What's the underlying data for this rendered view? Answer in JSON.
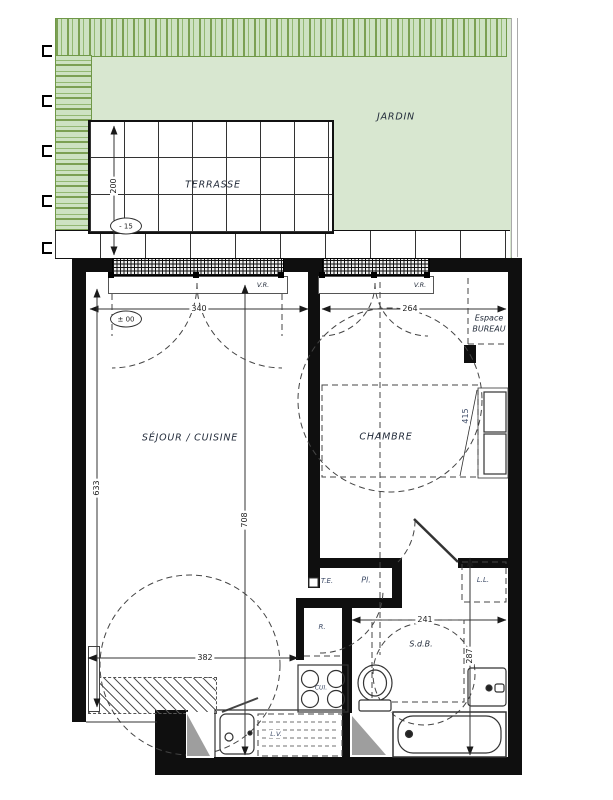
{
  "plan": {
    "rooms": {
      "jardin": "JARDIN",
      "terrasse": "TERRASSE",
      "sejour_cuisine": "SÉJOUR / CUISINE",
      "chambre": "CHAMBRE",
      "espace_bureau_line1": "Espace",
      "espace_bureau_line2": "BUREAU",
      "sdb": "S.d.B."
    },
    "equipment": {
      "vr": "V.R.",
      "te": "T.E.",
      "pl": "Pl.",
      "r": "R.",
      "cui": "CUI.",
      "lv": "L.V.",
      "ll": "L.L."
    },
    "levels": {
      "terrasse": "- 15",
      "interieur": "± 00"
    },
    "dimensions": {
      "terrasse_depth": "200",
      "sejour_window": "340",
      "chambre_window": "264",
      "sejour_depth": "633",
      "total_depth": "708",
      "sejour_width": "382",
      "sdb_width": "241",
      "sdb_depth": "287",
      "chambre_depth": "415"
    },
    "colors": {
      "garden_fill": "#d8e7d0",
      "hedge_stroke": "#6f9848",
      "wall": "#0f0f0f",
      "label_blue": "#3c4a66",
      "line": "#222222"
    }
  }
}
